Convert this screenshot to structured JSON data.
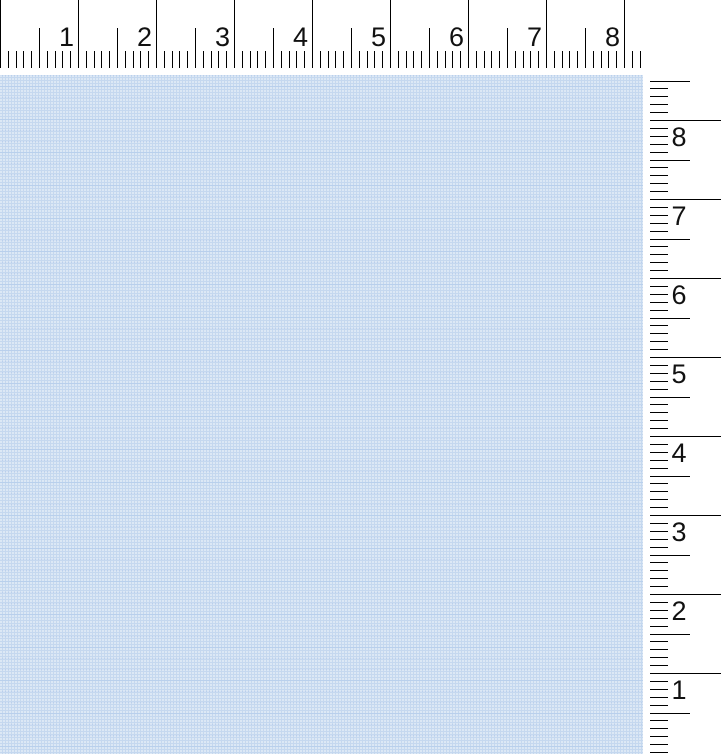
{
  "canvas": {
    "fill_base": "#c5d8ef",
    "fill_dot": "#dce8f8",
    "texture": "dithered-light-blue"
  },
  "horizontal_ruler": {
    "side": "top",
    "numbers": [
      "1",
      "2",
      "3",
      "4",
      "5",
      "6",
      "7",
      "8"
    ],
    "unit_px": 78,
    "subdivisions_per_unit": 10,
    "length_px": 641,
    "tick_color": "#000000",
    "number_color": "#111111",
    "font_px": 27,
    "major_top": 0,
    "medium_top": 28,
    "minor_top": 51,
    "tick_bottom": 68,
    "number_baseline": 46,
    "number_gap_px": 4
  },
  "vertical_ruler": {
    "side": "right",
    "numbers": [
      "8",
      "7",
      "6",
      "5",
      "4",
      "3",
      "2",
      "1"
    ],
    "unit_px": 79,
    "subdivisions_per_unit": 10,
    "first_major_y_px": 120,
    "top_px": 78,
    "bottom_px": 753,
    "tick_color": "#000000",
    "number_color": "#111111",
    "font_px": 27,
    "tick_start_x": 7,
    "major_len": 71,
    "medium_len": 40,
    "minor_len": 18,
    "number_center_x": 36,
    "number_baseline_offset": 26
  }
}
